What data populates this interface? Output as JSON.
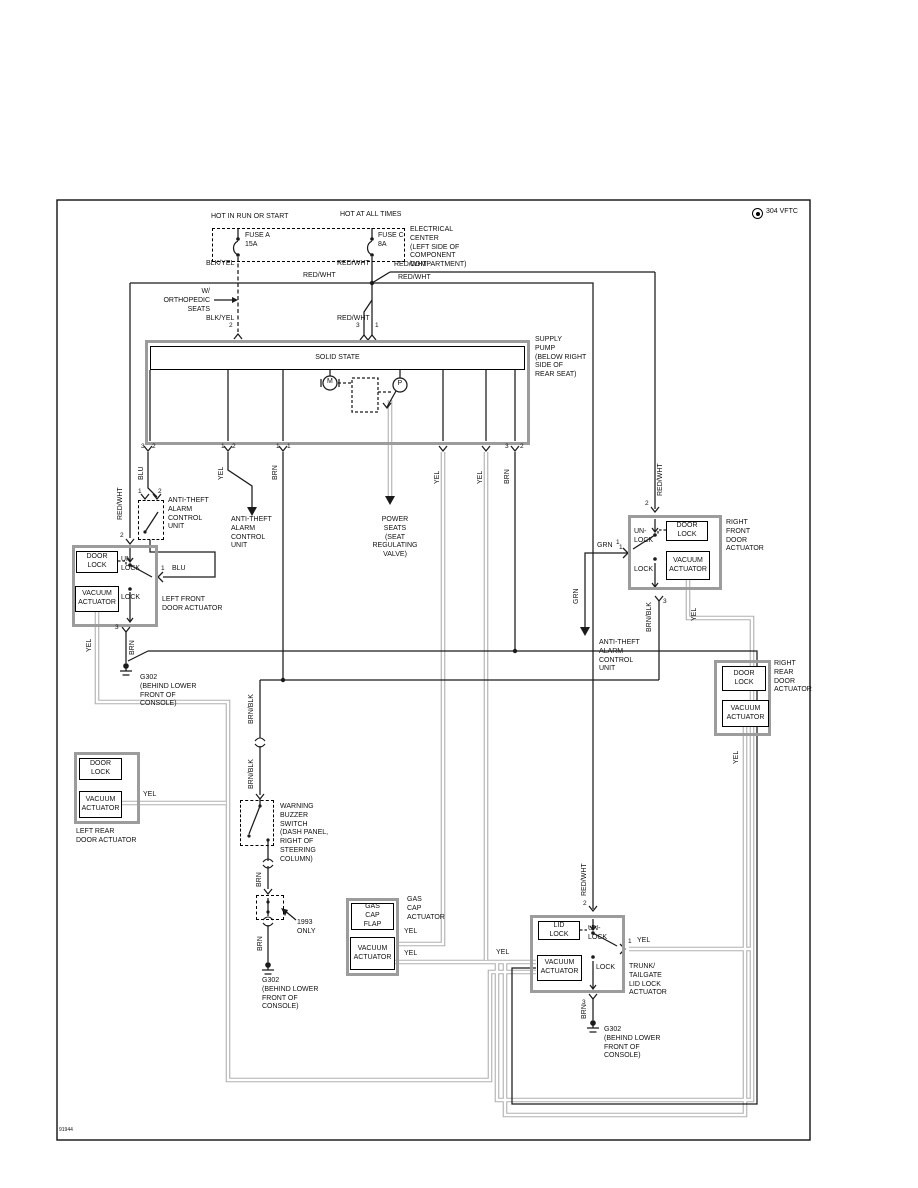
{
  "page": {
    "brand": "304 VFTC",
    "diagram_id": "91944"
  },
  "labels": {
    "hot_run": "HOT IN RUN OR START",
    "hot_all": "HOT AT ALL TIMES",
    "fuse_a": "FUSE A\n15A",
    "fuse_c": "FUSE C\n8A",
    "elec_center": "ELECTRICAL\nCENTER\n(LEFT SIDE OF\nCOMPONENT\nCOMPARTMENT)",
    "orthopedic": "W/\nORTHOPEDIC\nSEATS",
    "supply_pump": "SUPPLY\nPUMP\n(BELOW RIGHT\nSIDE OF\nREAR SEAT)",
    "power_seats": "POWER\nSEATS\n(SEAT\nREGULATING\nVALVE)",
    "ata": "ANTI-THEFT\nALARM\nCONTROL\nUNIT",
    "lf": "LEFT FRONT\nDOOR ACTUATOR",
    "rf": "RIGHT\nFRONT\nDOOR\nACTUATOR",
    "lr": "LEFT REAR\nDOOR ACTUATOR",
    "rr": "RIGHT\nREAR\nDOOR\nACTUATOR",
    "trunk": "TRUNK/\nTAILGATE\nLID LOCK\nACTUATOR",
    "gas": "GAS\nCAP\nACTUATOR",
    "buzzer": "WARNING\nBUZZER\nSWITCH\n(DASH PANEL,\nRIGHT OF\nSTEERING\nCOLUMN)",
    "only_1993": "1993\nONLY",
    "g302": "G302\n(BEHIND LOWER\nFRONT OF\nCONSOLE)"
  },
  "boxes": {
    "solid_state": "SOLID STATE",
    "door_lock": "DOOR\nLOCK",
    "vacuum": "VACUUM\nACTUATOR",
    "lid_lock": "LID\nLOCK",
    "gas_flap": "GAS\nCAP\nFLAP",
    "unlock": "UN-\nLOCK",
    "lock": "LOCK",
    "motor": "M",
    "pressure": "P"
  },
  "wires": {
    "redwht": "RED/WHT",
    "blkyel": "BLK/YEL",
    "yel": "YEL",
    "brn": "BRN",
    "blu": "BLU",
    "grn": "GRN",
    "brnblk": "BRN/BLK"
  },
  "pins": {
    "p1": "1",
    "p2": "2",
    "p3": "3"
  }
}
